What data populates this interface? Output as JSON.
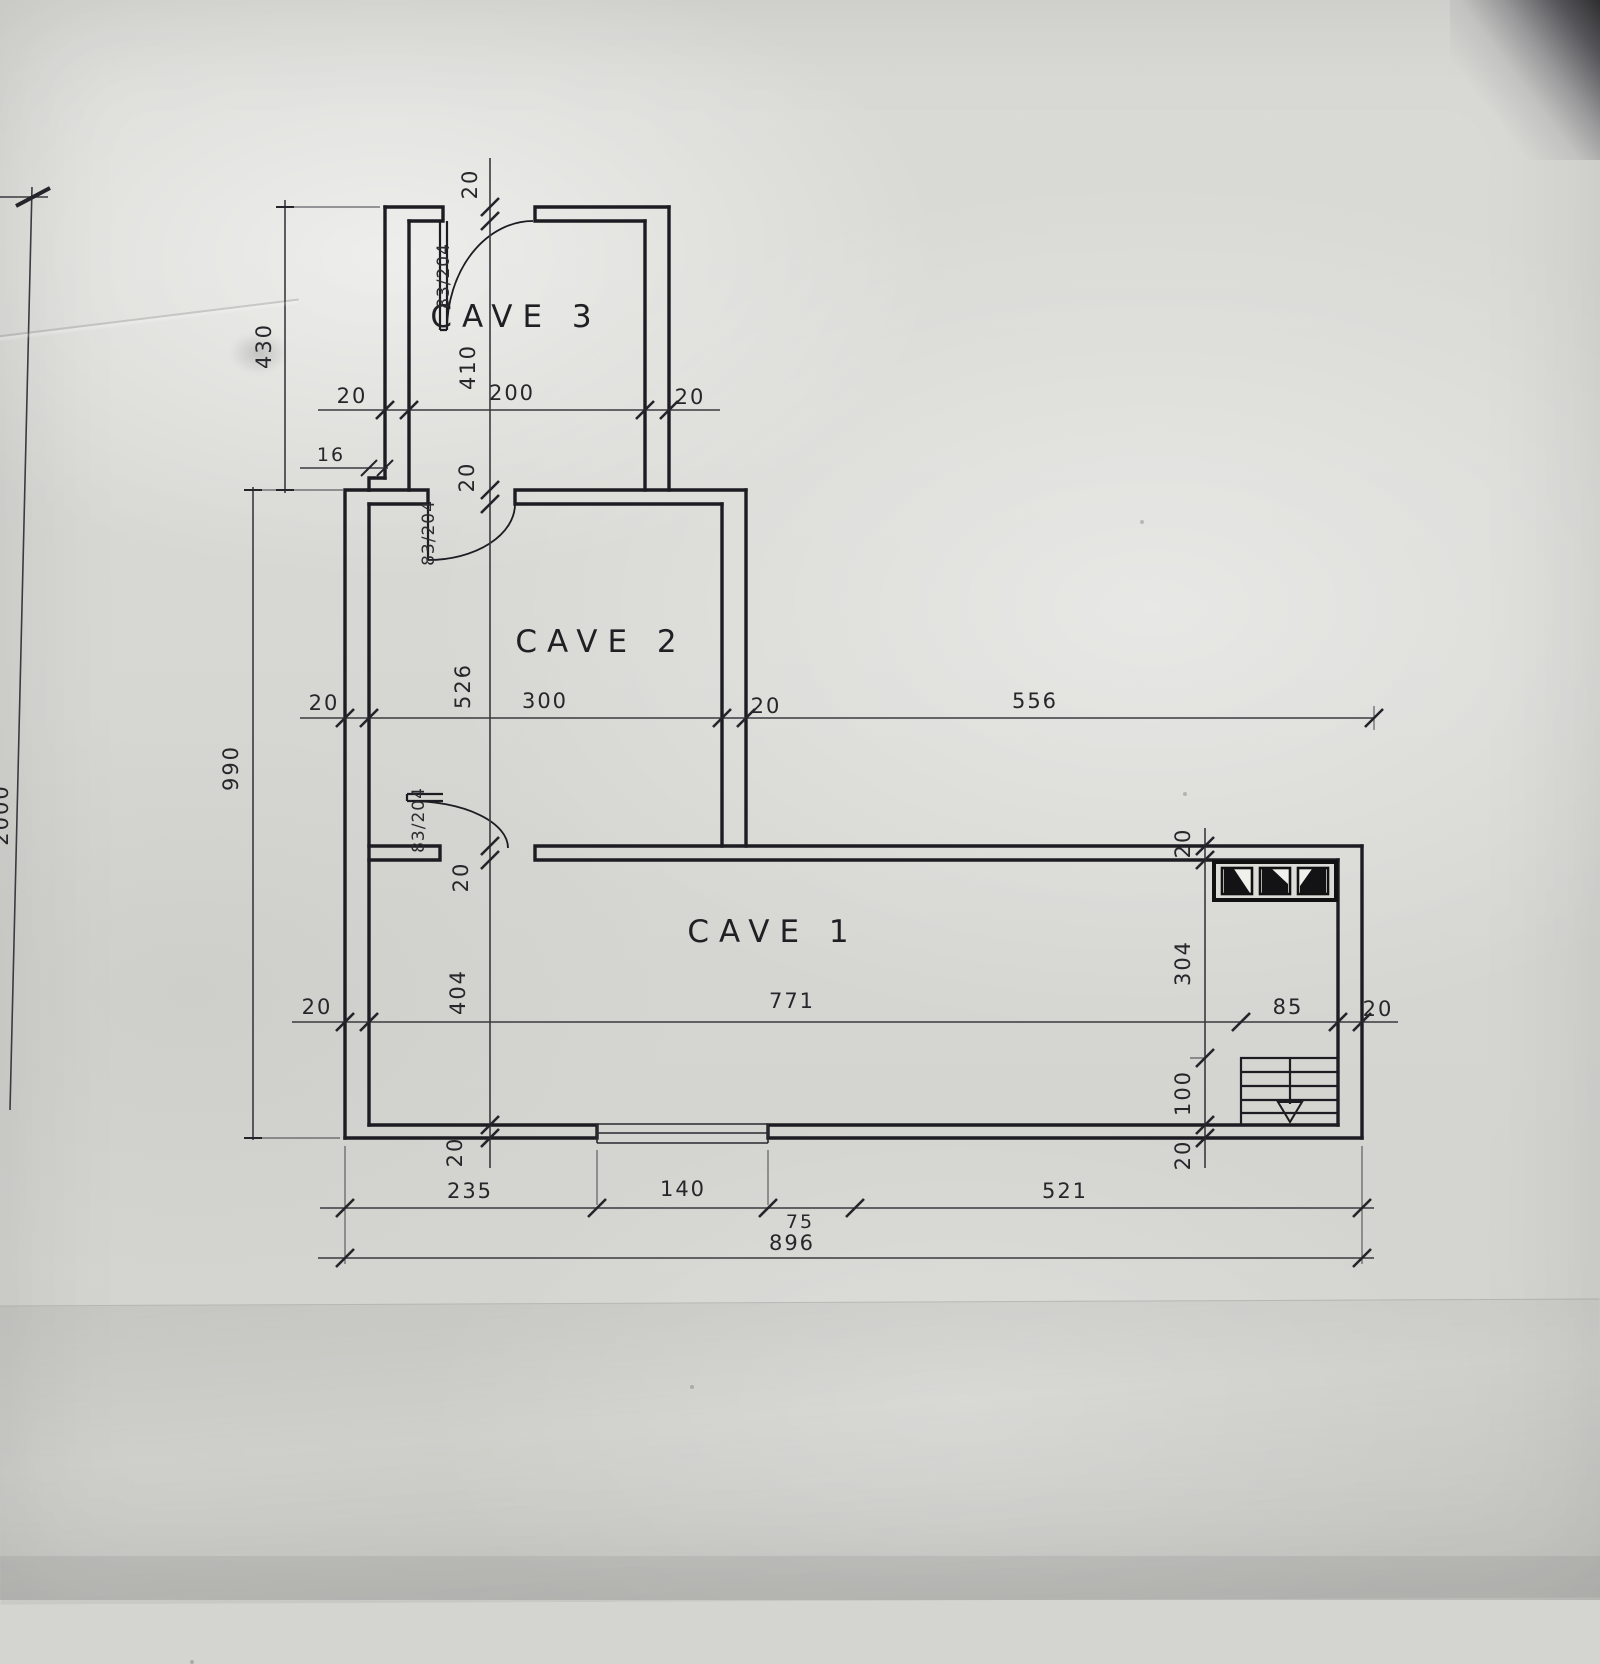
{
  "drawing": {
    "rooms": {
      "cave1": "CAVE 1",
      "cave2": "CAVE 2",
      "cave3": "CAVE 3"
    },
    "door_size_label": "83/204",
    "dims": {
      "wall": "20",
      "step": "16",
      "cave3_interior_width": "200",
      "cave3_interior_height": "410",
      "cave3_side_total": "430",
      "cave2_interior_width": "300",
      "cave2_interior_height": "526",
      "left_side_total": "990",
      "right_top_span": "556",
      "cave1_interior_width": "771",
      "cave1_interior_height": "404",
      "cave1_right_height": "304",
      "stair_width": "85",
      "stair_height": "100",
      "bottom_seg1": "235",
      "bottom_seg2": "140",
      "bottom_seg3": "75",
      "bottom_seg4": "521",
      "bottom_total": "896",
      "edge_partial": "2000"
    }
  }
}
